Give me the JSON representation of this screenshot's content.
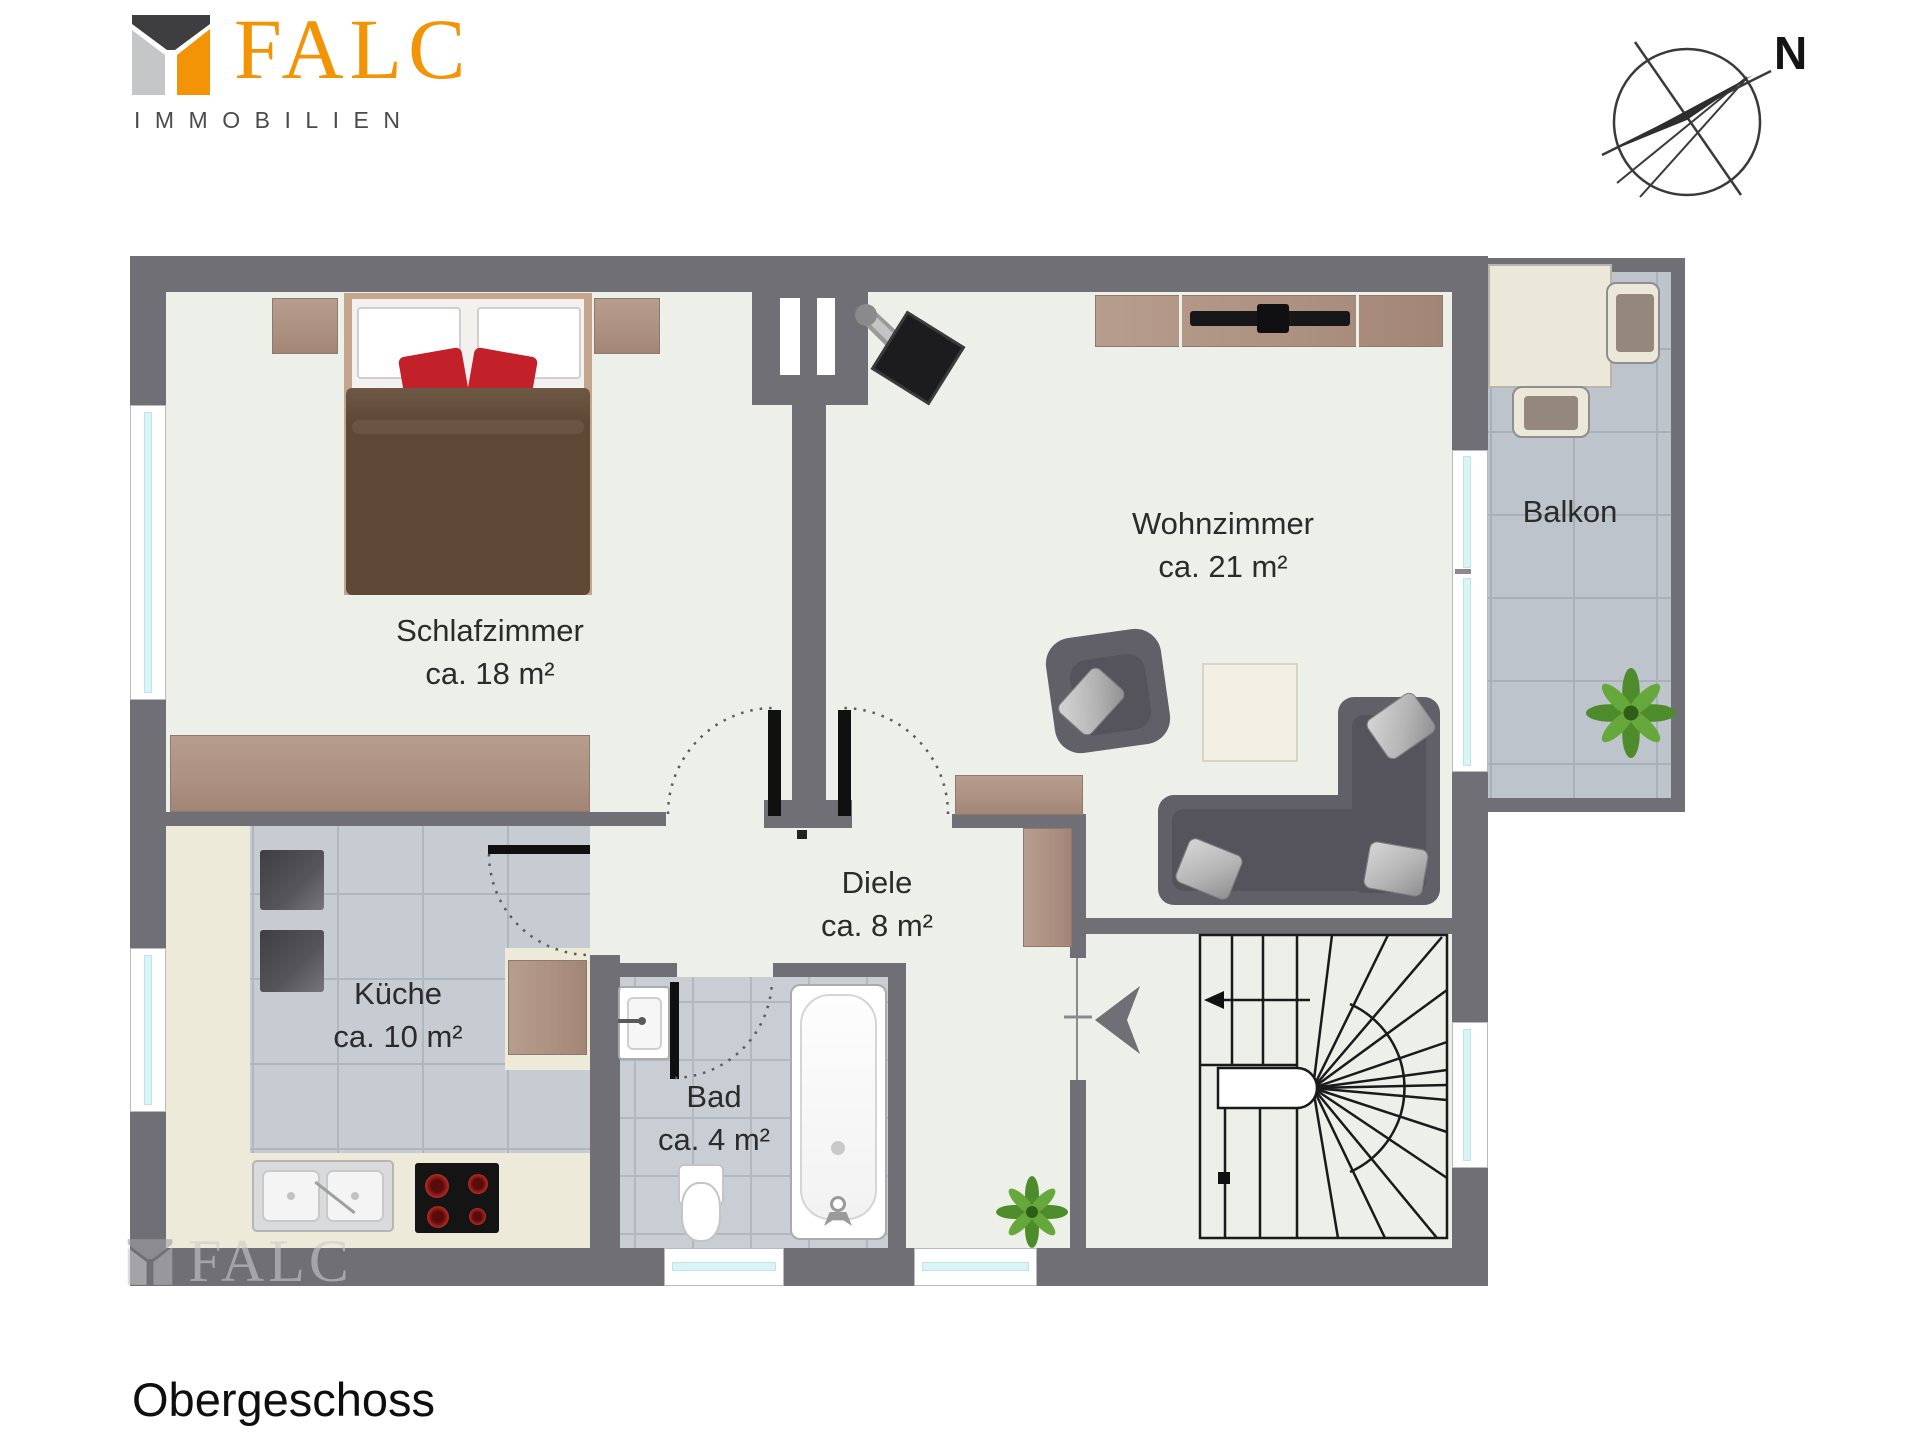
{
  "brand": {
    "name": "FALC",
    "subtitle": "IMMOBILIEN"
  },
  "compass": {
    "north_label": "N"
  },
  "plan": {
    "floor_label": "Obergeschoss",
    "rooms": [
      {
        "name": "Schlafzimmer",
        "area": "ca. 18 m²"
      },
      {
        "name": "Wohnzimmer",
        "area": "ca. 21 m²"
      },
      {
        "name": "Diele",
        "area": "ca. 8 m²"
      },
      {
        "name": "Küche",
        "area": "ca. 10 m²"
      },
      {
        "name": "Bad",
        "area": "ca. 4 m²"
      },
      {
        "name": "Balkon",
        "area": ""
      }
    ]
  },
  "watermark": {
    "text": "FALC"
  },
  "colors": {
    "wall": "#706F75",
    "floor": "#EDEFE9",
    "kitchen_tile": "#C7CCD2",
    "balcony_tile": "#BDC4CB",
    "window_glass": "#D8F4F7",
    "brand_orange": "#F29405",
    "accent_red": "#C32129",
    "wood": "#AD9181",
    "blanket_brown": "#5D4936"
  }
}
